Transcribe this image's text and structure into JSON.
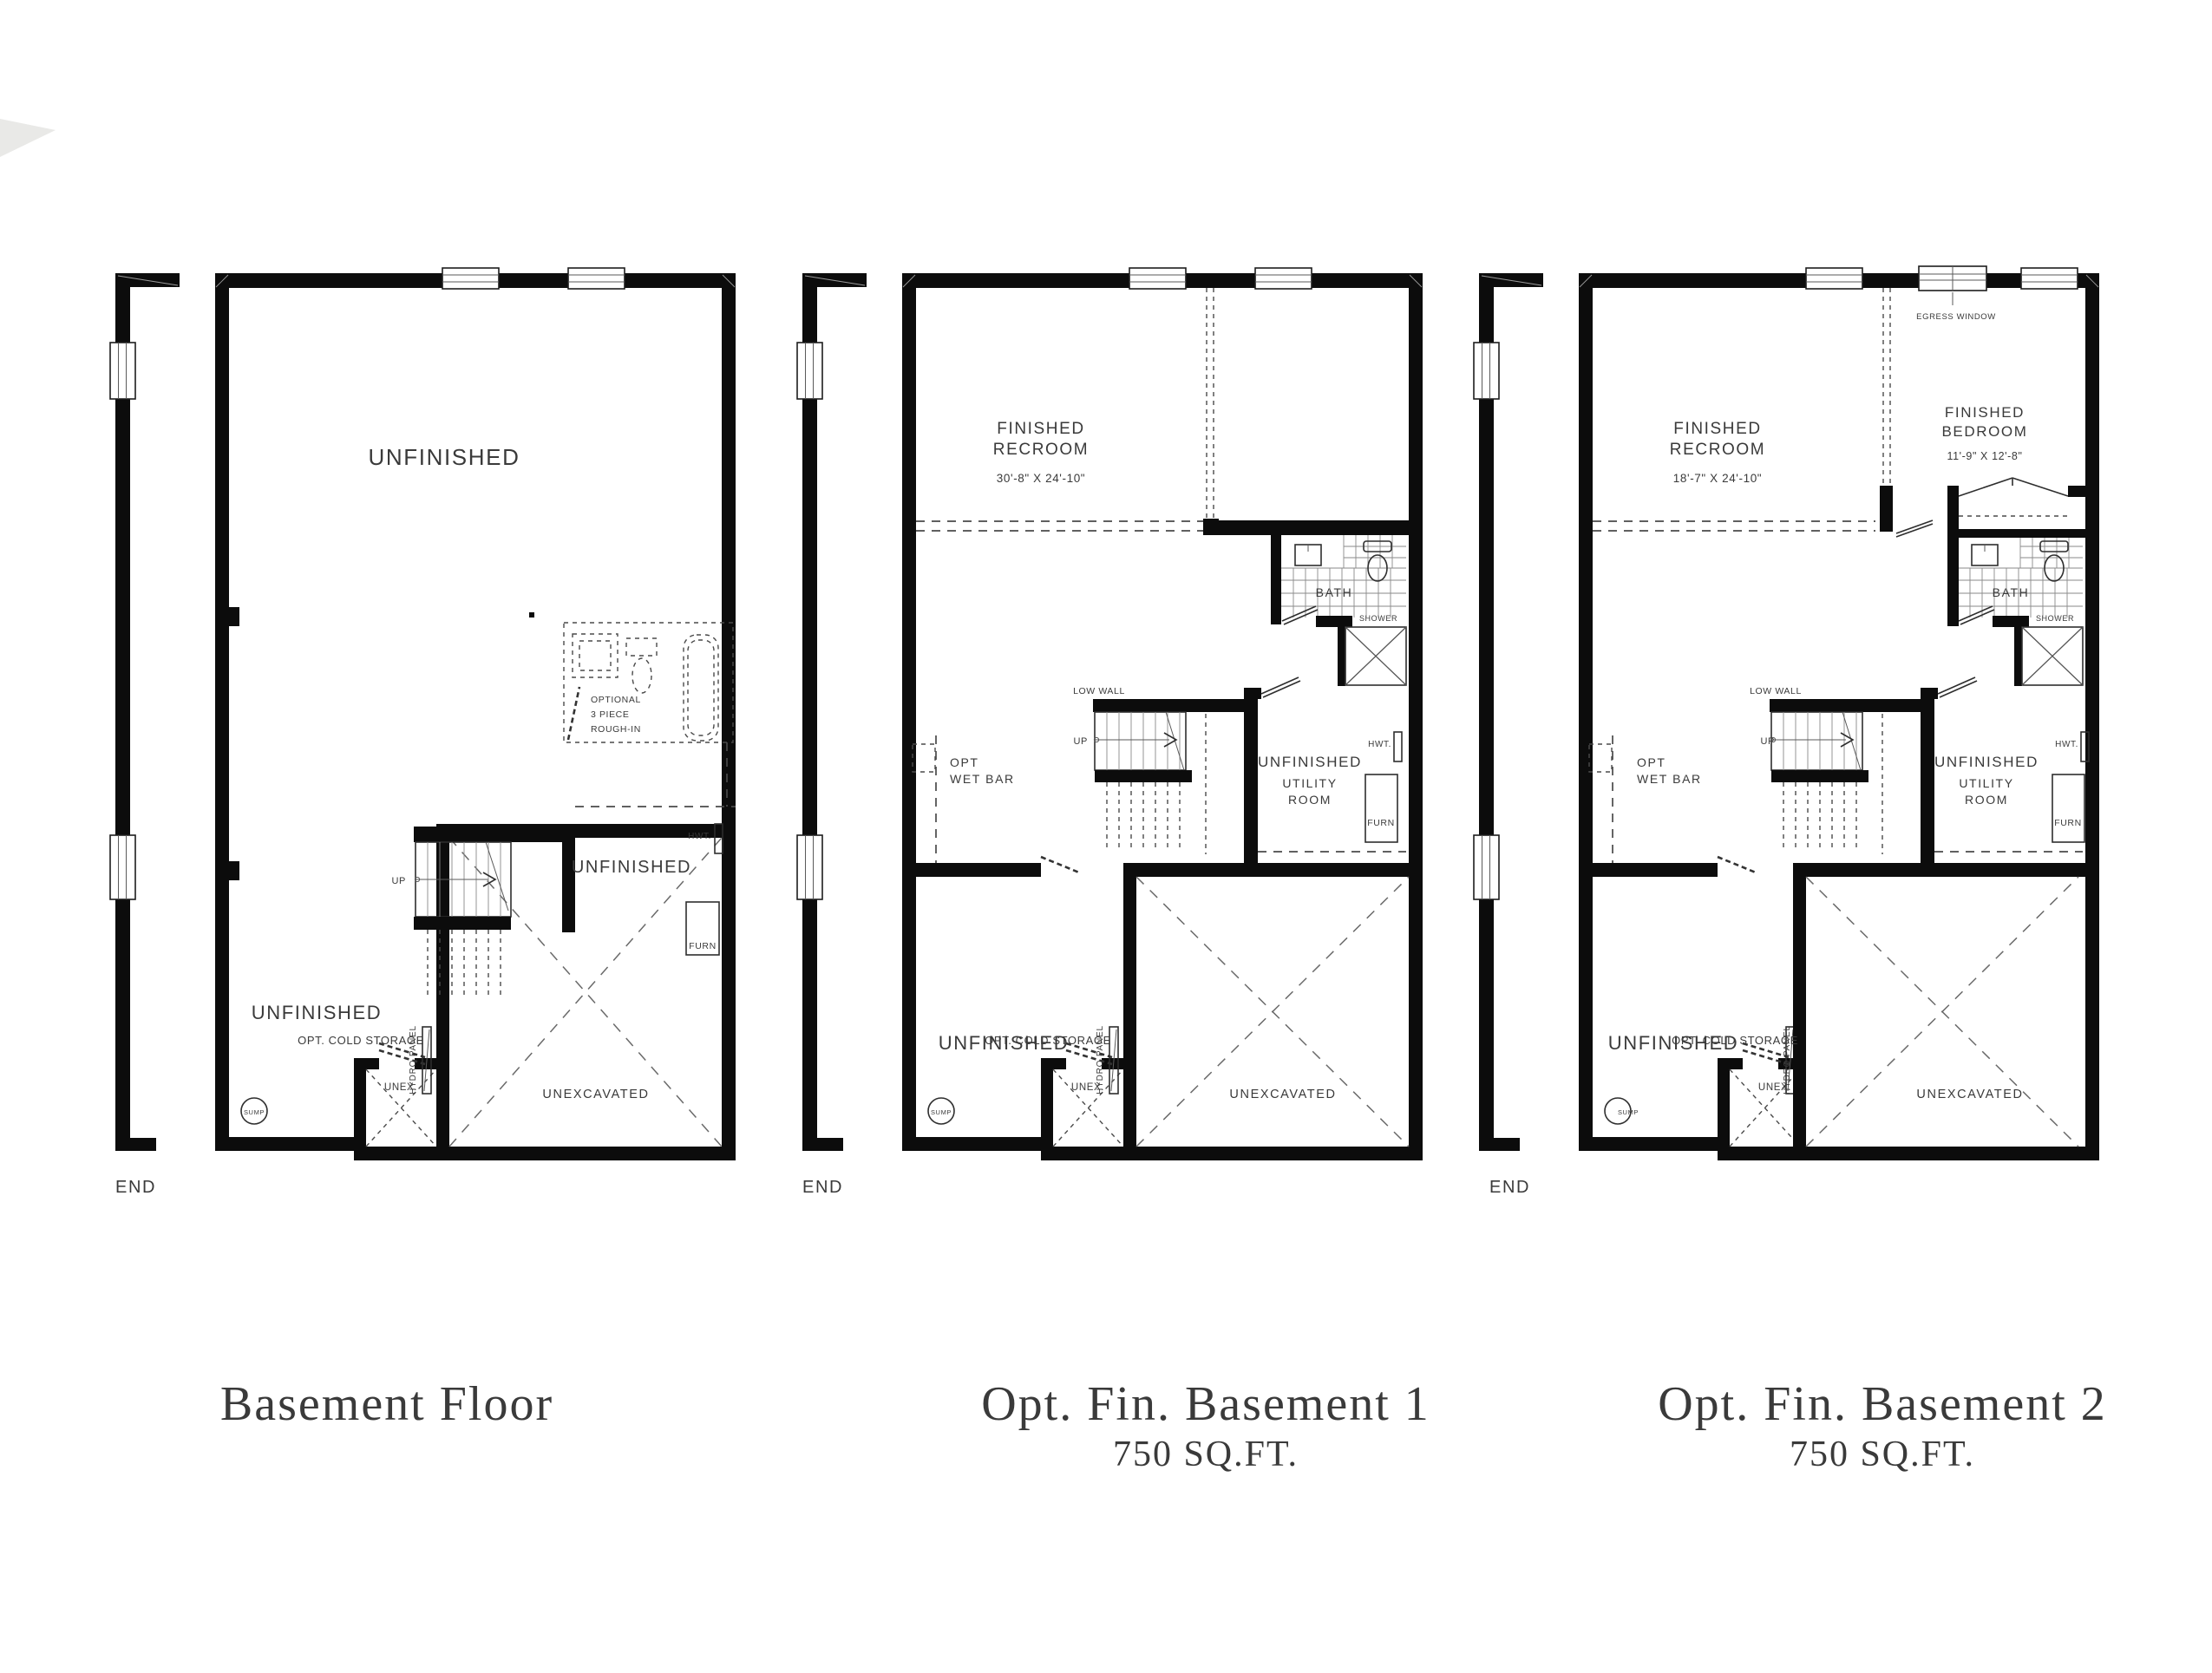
{
  "sheet": {
    "type": "architectural-floor-plan-sheet",
    "background": "#ffffff",
    "ink": "#0c0c0c"
  },
  "plans": [
    {
      "id": "basement-floor",
      "title": "Basement Floor",
      "labels": {
        "unfinished_top": "UNFINISHED",
        "optional_1": "OPTIONAL",
        "optional_2": "3 PIECE",
        "optional_3": "ROUGH-IN",
        "up": "UP",
        "hwt": "HWT.",
        "unfinished_mid": "UNFINISHED",
        "furn": "FURN",
        "unfinished_lower": "UNFINISHED",
        "hydro_panel": "HYDRO PANEL",
        "opt_cold_storage": "OPT. COLD STORAGE",
        "unex": "UNEX.",
        "sump": "SUMP",
        "unexcavated": "UNEXCAVATED",
        "end": "END"
      }
    },
    {
      "id": "opt-fin-basement-1",
      "title": "Opt. Fin. Basement 1",
      "subtitle": "750 SQ.FT.",
      "labels": {
        "finished": "FINISHED",
        "recroom": "RECROOM",
        "recroom_dims": "30'-8\" X 24'-10\"",
        "bath": "BATH",
        "shower": "SHOWER",
        "low_wall": "LOW WALL",
        "up": "UP",
        "opt": "OPT",
        "wet_bar": "WET BAR",
        "unfinished_utility": "UNFINISHED",
        "utility": "UTILITY",
        "room": "ROOM",
        "hwt": "HWT.",
        "furn": "FURN",
        "unfinished_lower": "UNFINISHED",
        "hydro_panel": "HYDRO PANEL",
        "opt_cold_storage": "OPT. COLD STORAGE",
        "unex": "UNEX.",
        "sump": "SUMP",
        "unexcavated": "UNEXCAVATED",
        "end": "END"
      }
    },
    {
      "id": "opt-fin-basement-2",
      "title": "Opt. Fin. Basement 2",
      "subtitle": "750 SQ.FT.",
      "labels": {
        "finished": "FINISHED",
        "recroom": "RECROOM",
        "recroom_dims": "18'-7\" X 24'-10\"",
        "finished_bed": "FINISHED",
        "bedroom": "BEDROOM",
        "bedroom_dims": "11'-9\" X 12'-8\"",
        "egress_window": "EGRESS WINDOW",
        "bath": "BATH",
        "shower": "SHOWER",
        "low_wall": "LOW WALL",
        "up": "UP",
        "opt": "OPT",
        "wet_bar": "WET BAR",
        "unfinished_utility": "UNFINISHED",
        "utility": "UTILITY",
        "room": "ROOM",
        "hwt": "HWT.",
        "furn": "FURN",
        "unfinished_lower": "UNFINISHED",
        "hydro_panel": "HYDRO PANEL",
        "opt_cold_storage": "OPT. COLD STORAGE",
        "unex": "UNEX.",
        "sump": "SUMP",
        "unexcavated": "UNEXCAVATED",
        "end": "END"
      }
    }
  ]
}
